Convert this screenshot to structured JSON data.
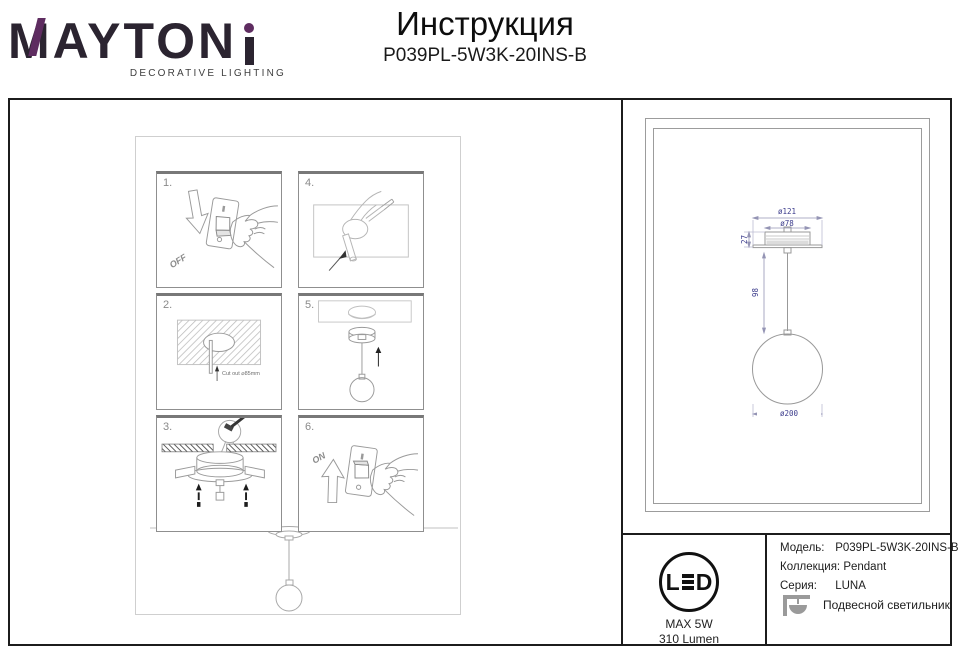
{
  "brand": {
    "name": "MAYTONI",
    "name_prefix": "MAYTON",
    "tagline": "DECORATIVE LIGHTING"
  },
  "header": {
    "title": "Инструкция",
    "model": "P039PL-5W3K-20INS-B"
  },
  "steps": [
    {
      "number": "1.",
      "caption": "OFF"
    },
    {
      "number": "2.",
      "caption": "Cut out ⌀85mm"
    },
    {
      "number": "3.",
      "caption": ""
    },
    {
      "number": "4.",
      "caption": ""
    },
    {
      "number": "5.",
      "caption": ""
    },
    {
      "number": "6.",
      "caption": "ON"
    }
  ],
  "technical_drawing": {
    "dim_canopy_outer": "ø121",
    "dim_canopy_inner": "ø78",
    "dim_recess_depth": "27",
    "dim_stem_length": "98",
    "dim_sphere": "ø200"
  },
  "led_badge": {
    "letter_l": "L",
    "letter_d": "D",
    "max_power": "MAX 5W",
    "luminous_flux": "310 Lumen"
  },
  "specs": {
    "rows": [
      {
        "label": "Модель:",
        "value": "P039PL-5W3K-20INS-B"
      },
      {
        "label": "Коллекция:",
        "value": "Pendant"
      },
      {
        "label": "Серия:",
        "value": "LUNA"
      }
    ],
    "type_label": "Подвесной светильник"
  },
  "colors": {
    "brand_purple": "#5e2c60",
    "dimension_ink": "#3c3c8c",
    "line_gray": "#9a9a9a"
  }
}
